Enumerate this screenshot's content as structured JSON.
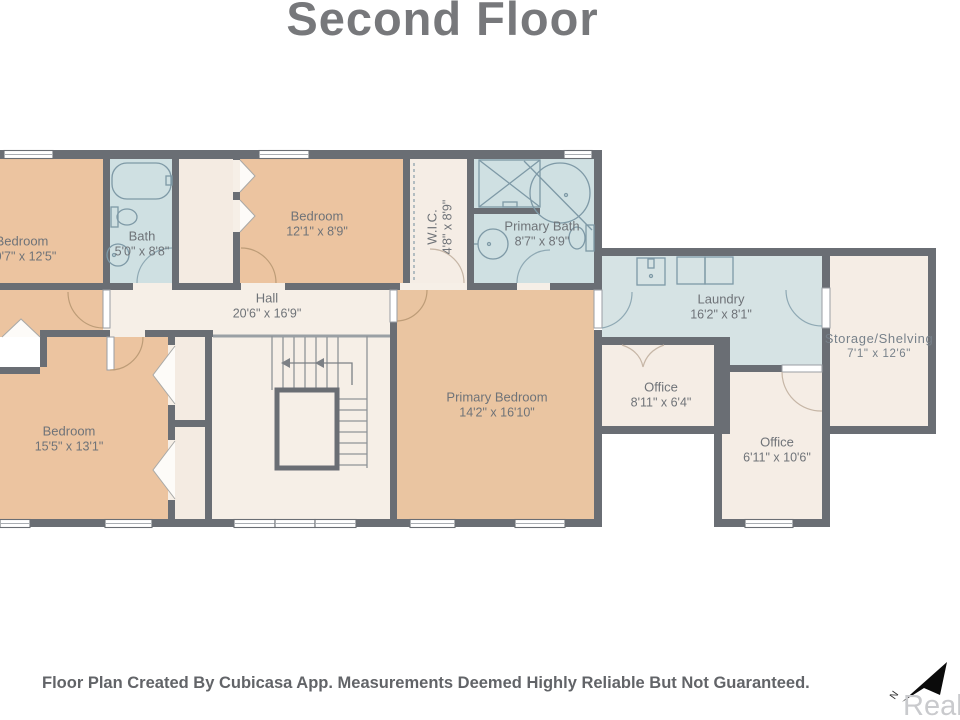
{
  "title": "Second Floor",
  "disclaimer": "Floor Plan Created By Cubicasa App. Measurements Deemed Highly Reliable But Not Guaranteed.",
  "watermark": "Realco",
  "compass": {
    "label": "N"
  },
  "colors": {
    "wall": "#6a6e74",
    "room_tan": "#ecc4a0",
    "room_cream": "#f6efe7",
    "room_closet": "#f4ebe2",
    "room_blue": "#cfe0e2",
    "room_laundry": "#d6e3e4",
    "label_text": "#6f7378",
    "title_text": "#77787b",
    "fixture_stroke": "#7e99a6"
  },
  "rooms": [
    {
      "id": "bedroom-tl",
      "name": "Bedroom",
      "dims": "10'7\" x 12'5\""
    },
    {
      "id": "bath",
      "name": "Bath",
      "dims": "5'0\" x 8'8\""
    },
    {
      "id": "bedroom-top",
      "name": "Bedroom",
      "dims": "12'1\" x 8'9\""
    },
    {
      "id": "wic",
      "name": "W.I.C.",
      "dims": "4'8\" x 8'9\""
    },
    {
      "id": "primary-bath",
      "name": "Primary Bath",
      "dims": "8'7\" x 8'9\""
    },
    {
      "id": "hall",
      "name": "Hall",
      "dims": "20'6\" x 16'9\""
    },
    {
      "id": "primary-bedroom",
      "name": "Primary Bedroom",
      "dims": "14'2\" x 16'10\""
    },
    {
      "id": "laundry",
      "name": "Laundry",
      "dims": "16'2\" x 8'1\""
    },
    {
      "id": "storage",
      "name": "Storage/Shelving",
      "dims": "7'1\" x 12'6\""
    },
    {
      "id": "office-1",
      "name": "Office",
      "dims": "8'11\" x 6'4\""
    },
    {
      "id": "office-2",
      "name": "Office",
      "dims": "6'11\" x 10'6\""
    },
    {
      "id": "bedroom-bl",
      "name": "Bedroom",
      "dims": "15'5\" x 13'1\""
    }
  ]
}
